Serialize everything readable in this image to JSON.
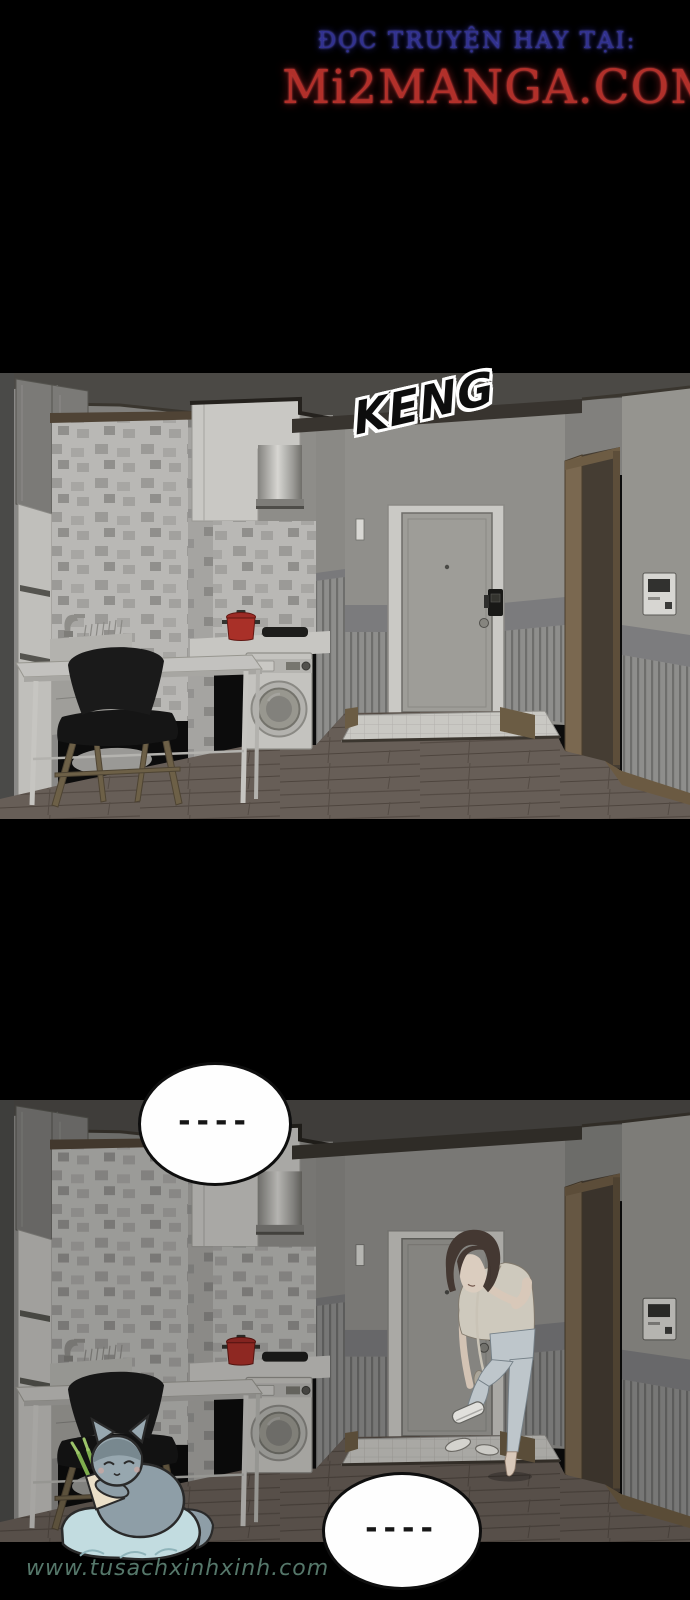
{
  "header": {
    "tagline": "ĐỌC TRUYỆN HAY TẠI:",
    "site": "Mi2MANGA.COM",
    "tagline_color": "#31318f",
    "site_color": "#b1302a"
  },
  "panels": {
    "panel1": {
      "sfx": "KENG"
    },
    "panel2": {
      "bubble_top": "----",
      "bubble_bottom": "----"
    }
  },
  "watermark": {
    "text": "www.tusachxinhxinh.com",
    "color": "#5f8476"
  },
  "scene_colors": {
    "ceiling": "#4b4945",
    "wall_grey": "#908f8b",
    "tile_base": "#b9b8b5",
    "tile_accent": "#908f8c",
    "door_slab": "#9e9d98",
    "door_frame": "#cac9c5",
    "trim_brown": "#6b5a42",
    "floor_wood": "#675e57",
    "pot_red": "#a93028",
    "cooktop_black": "#1d1d1b",
    "chair_black": "#161616",
    "woman_shirt": "#ded8cb",
    "woman_jeans": "#ccd5da",
    "cat_grey": "#93a3ab",
    "cushion_blue": "#c2dce0",
    "leek_green": "#7fae4e"
  }
}
